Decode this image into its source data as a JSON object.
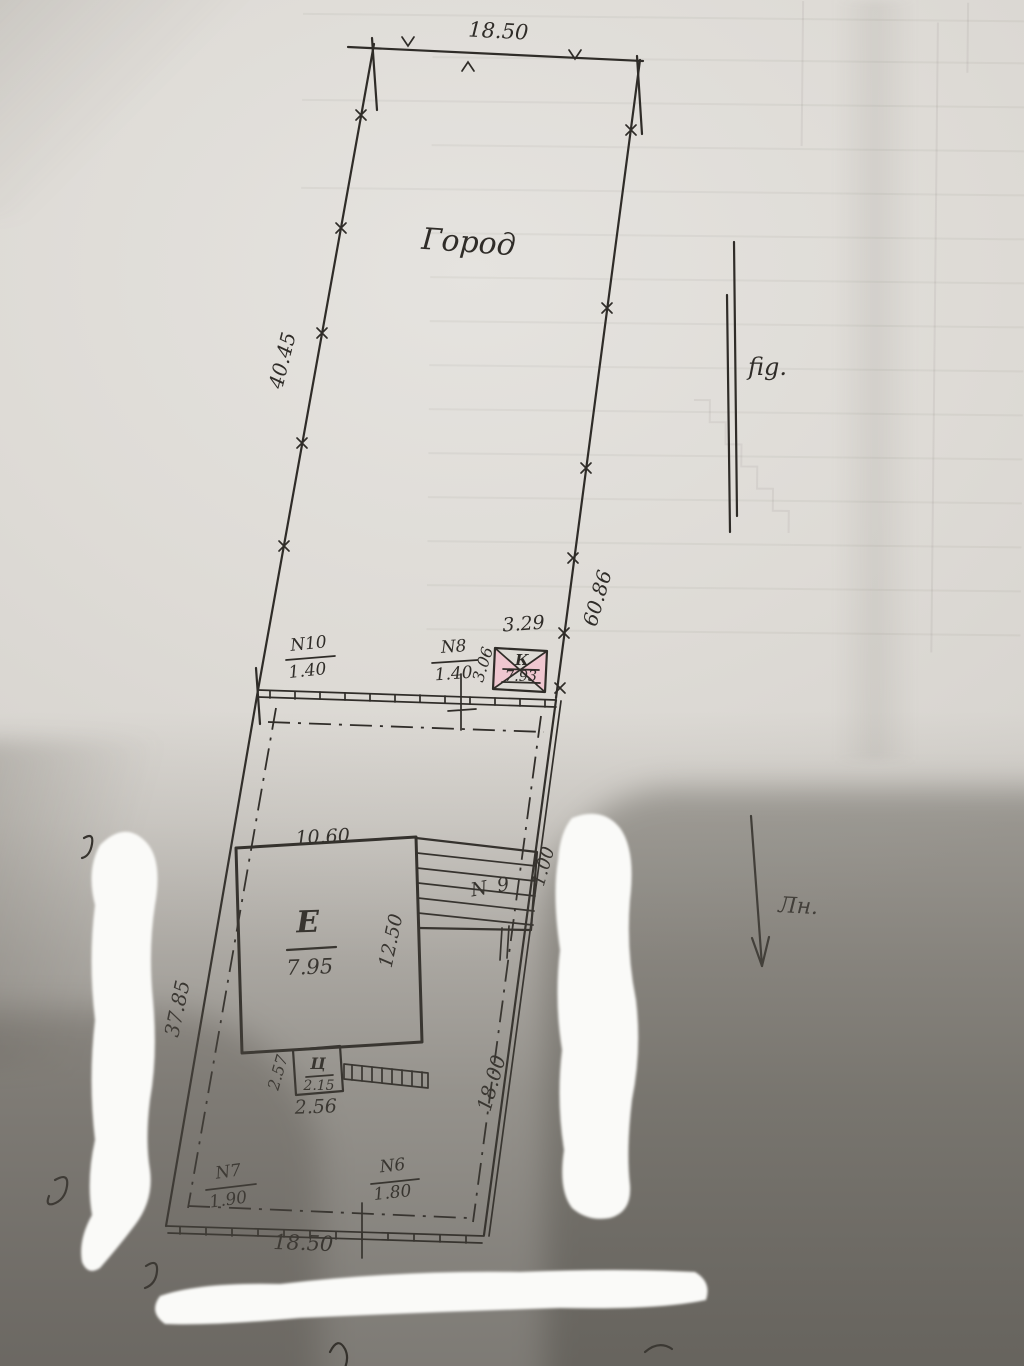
{
  "colors": {
    "ink": "#2f2c28",
    "paper": "#dad7d2",
    "building_fill": "#e2c3c6",
    "well_fill": "#efc7d0",
    "blob_white": "#fafaf8"
  },
  "plan": {
    "garden_label": "Город",
    "dims": {
      "top": "18.50",
      "left_upper": "40.45",
      "right_upper": "60.86",
      "left_lower": "37.85",
      "right_lower": "18.00",
      "right_mid": "1.00",
      "bottom": "18.50"
    },
    "annotations": {
      "upper_right": "fig.",
      "north_arrow": "Лн."
    },
    "well": {
      "top": "3.29",
      "left": "3.06",
      "letter": "К",
      "value": "7.93"
    },
    "fences_upper": {
      "n10": {
        "no": "N10",
        "size": "1.40"
      },
      "n8": {
        "no": "N8",
        "size": "1.40"
      }
    },
    "building": {
      "width": "10.60",
      "letter": "E",
      "value": "7.95",
      "depth": "12.50",
      "porch_no": "N 9"
    },
    "shed": {
      "left": "2.57",
      "letter": "Ц",
      "value": "2.15",
      "bottom": "2.56"
    },
    "fences_lower": {
      "n7": {
        "no": "N7",
        "size": "1.90"
      },
      "n6": {
        "no": "N6",
        "size": "1.80"
      }
    }
  }
}
